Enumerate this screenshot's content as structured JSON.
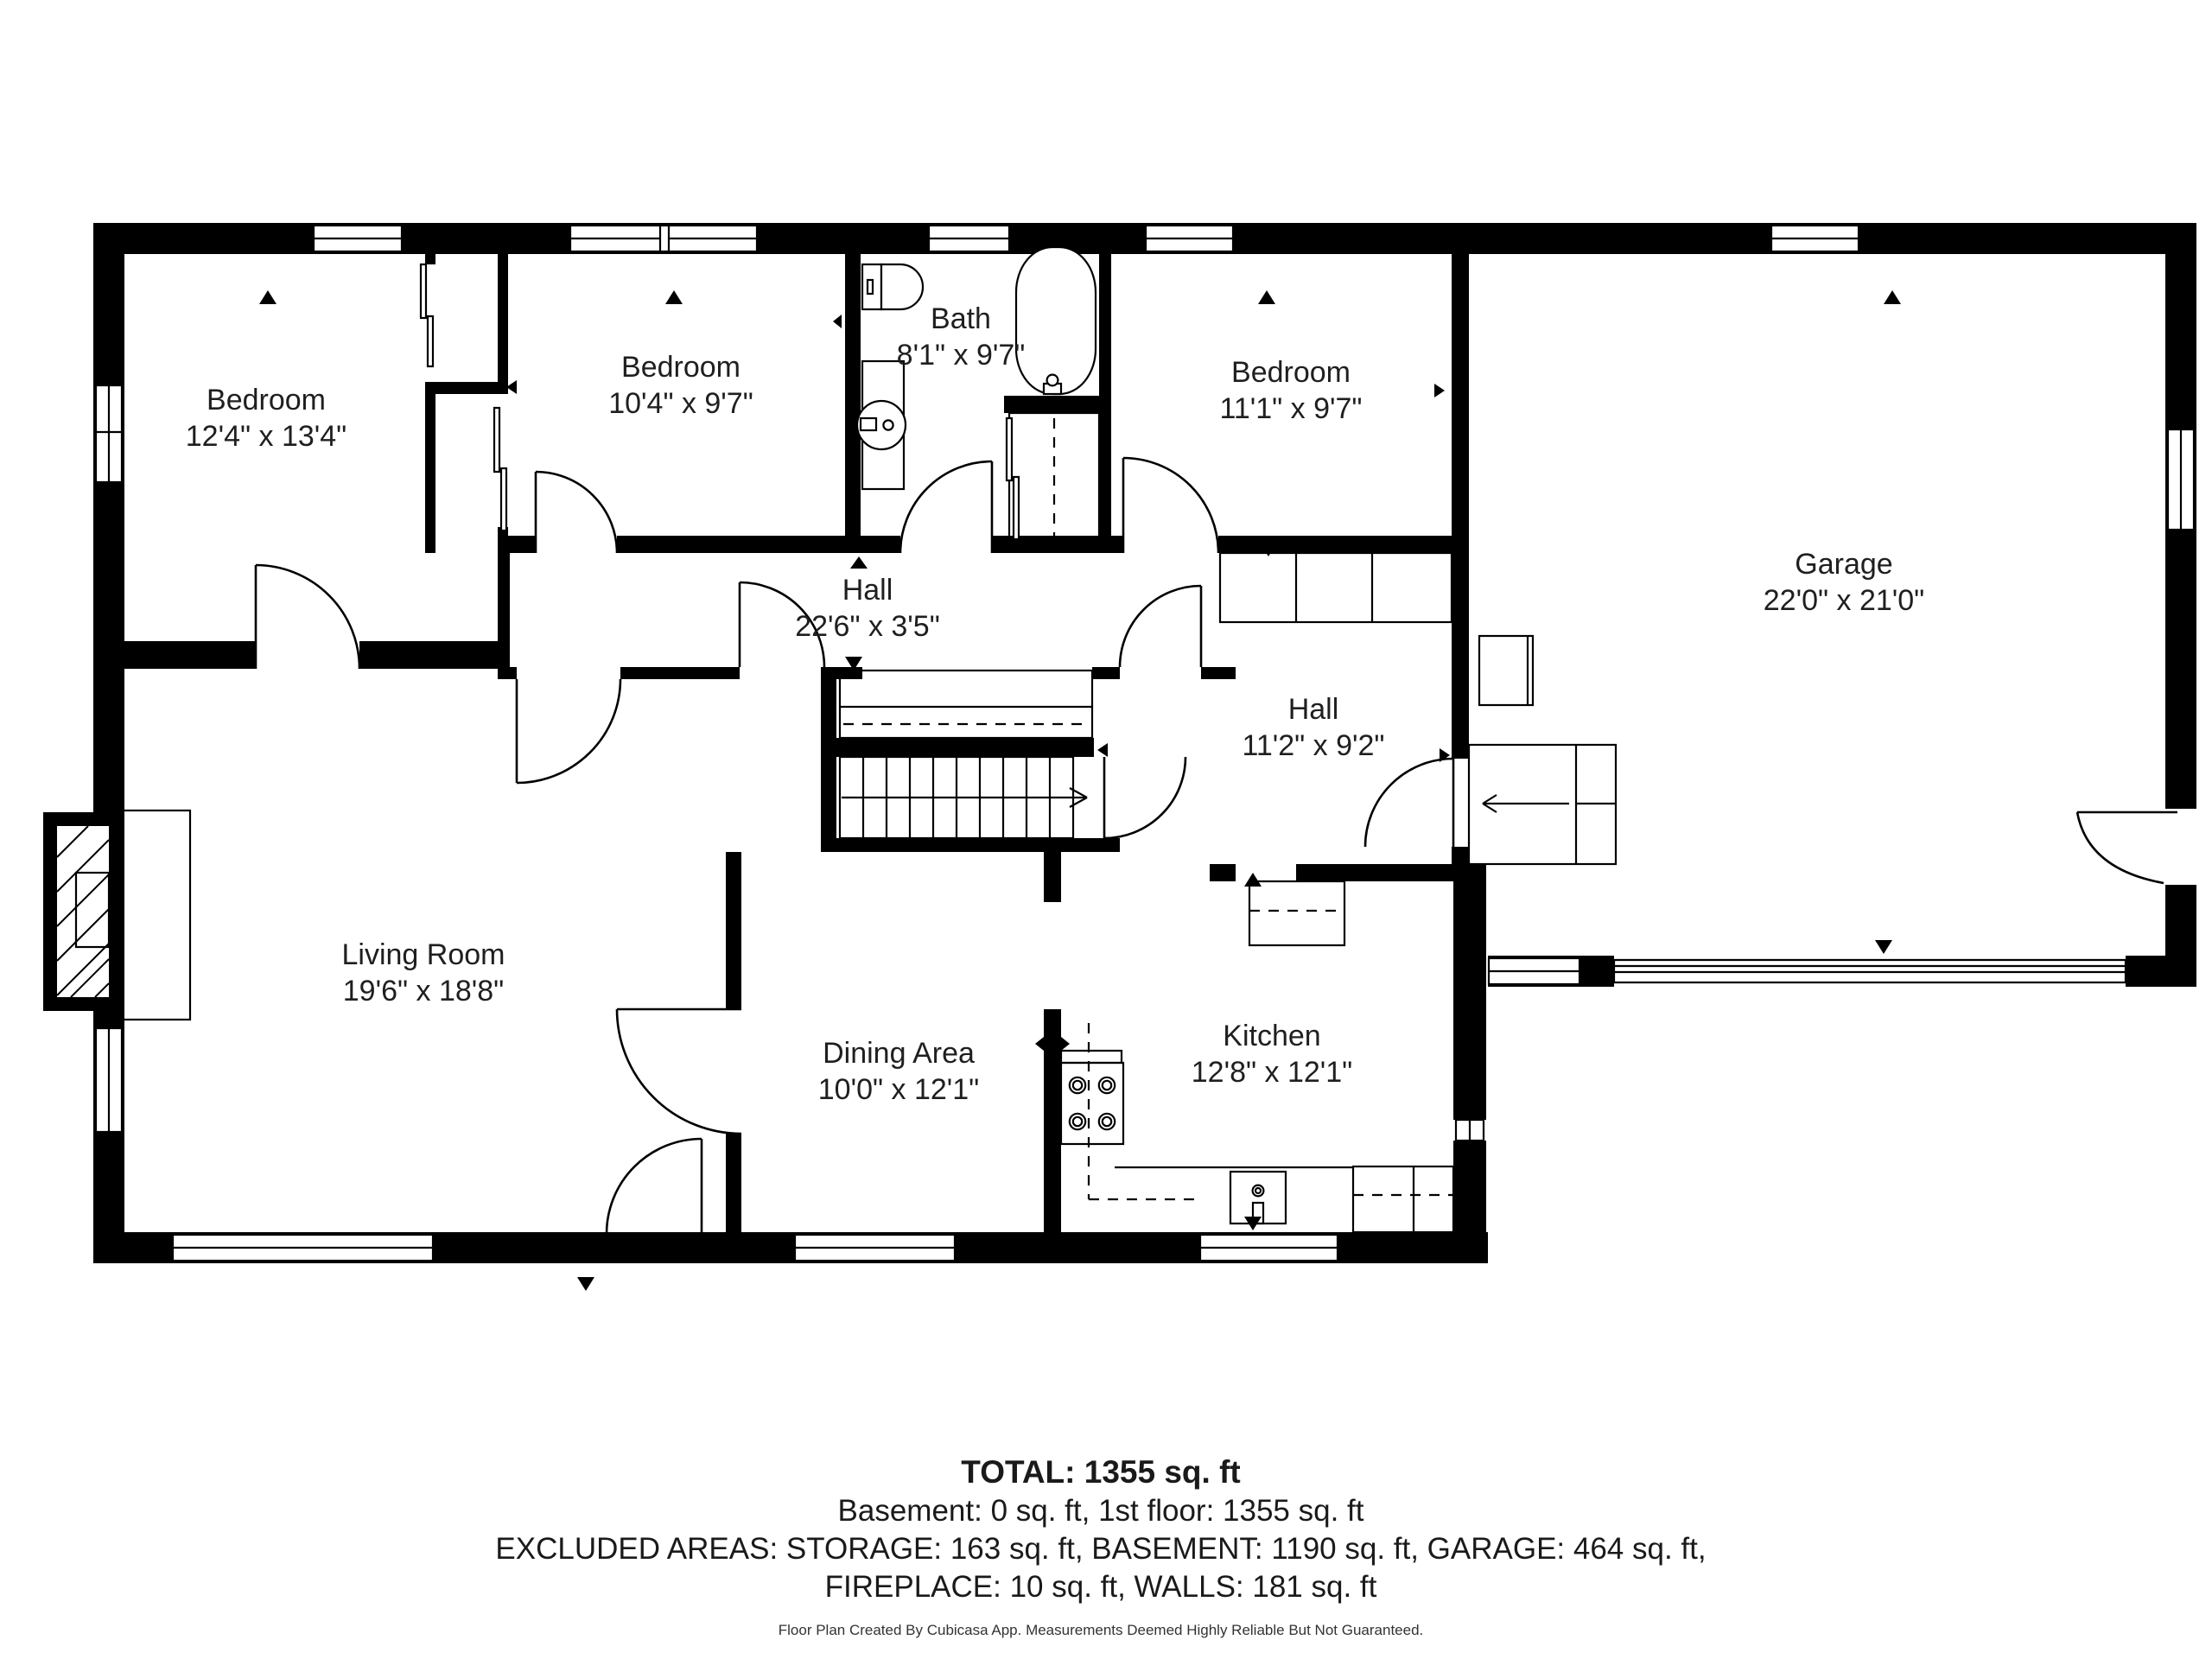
{
  "floorplan": {
    "title": "First floor plan",
    "colors": {
      "wall": "#000000",
      "background": "#ffffff",
      "text": "#1f1f1f"
    },
    "rooms": [
      {
        "id": "bedroom-1",
        "name": "Bedroom",
        "dims": "12'4\" x 13'4\""
      },
      {
        "id": "bedroom-2",
        "name": "Bedroom",
        "dims": "10'4\" x 9'7\""
      },
      {
        "id": "bath",
        "name": "Bath",
        "dims": "8'1\" x 9'7\""
      },
      {
        "id": "bedroom-3",
        "name": "Bedroom",
        "dims": "11'1\" x 9'7\""
      },
      {
        "id": "garage",
        "name": "Garage",
        "dims": "22'0\" x 21'0\""
      },
      {
        "id": "hall-1",
        "name": "Hall",
        "dims": "22'6\" x 3'5\""
      },
      {
        "id": "hall-2",
        "name": "Hall",
        "dims": "11'2\" x 9'2\""
      },
      {
        "id": "living-room",
        "name": "Living Room",
        "dims": "19'6\" x 18'8\""
      },
      {
        "id": "dining-area",
        "name": "Dining Area",
        "dims": "10'0\" x 12'1\""
      },
      {
        "id": "kitchen",
        "name": "Kitchen",
        "dims": "12'8\" x 12'1\""
      }
    ],
    "summary": {
      "total": "TOTAL: 1355 sq. ft",
      "line1": "Basement: 0 sq. ft, 1st floor: 1355 sq. ft",
      "line2": "EXCLUDED AREAS: STORAGE: 163 sq. ft, BASEMENT: 1190 sq. ft, GARAGE: 464 sq. ft,",
      "line3": "FIREPLACE: 10 sq. ft, WALLS: 181 sq. ft"
    },
    "footer": "Floor Plan Created By Cubicasa App. Measurements Deemed Highly Reliable But Not Guaranteed."
  }
}
